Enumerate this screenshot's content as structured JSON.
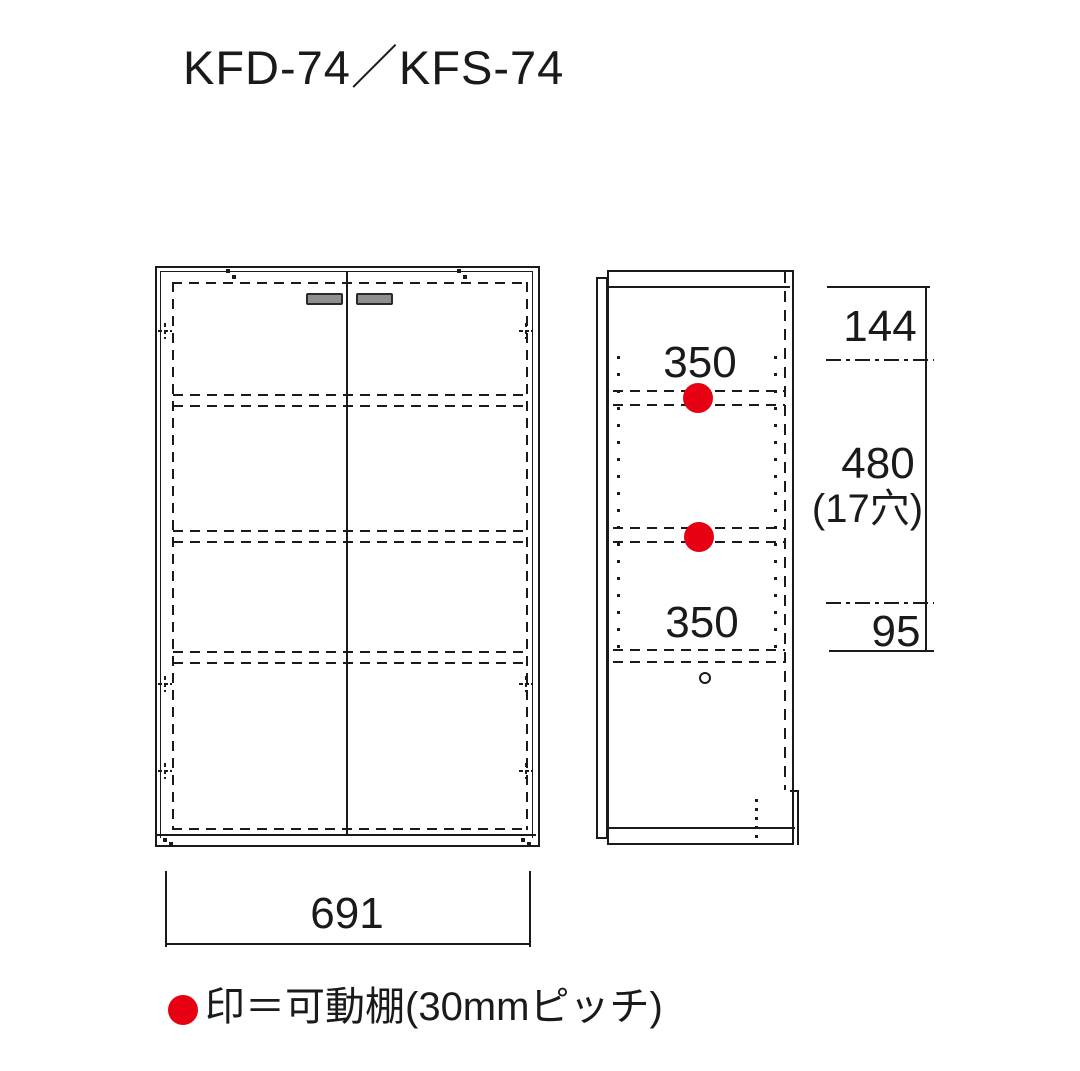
{
  "title": "KFD-74／KFS-74",
  "colors": {
    "line": "#1a1a1a",
    "accent_red": "#e60012",
    "handle_gray": "#8f8f8f"
  },
  "front_view": {
    "width_dim": "691"
  },
  "side_view": {
    "upper_section_label": "350",
    "lower_section_label": "350",
    "dimensions": {
      "top": "144",
      "middle": "480",
      "middle_note": "(17穴)",
      "bottom": "95"
    }
  },
  "legend": {
    "text": "印＝可動棚(30mmピッチ)"
  }
}
